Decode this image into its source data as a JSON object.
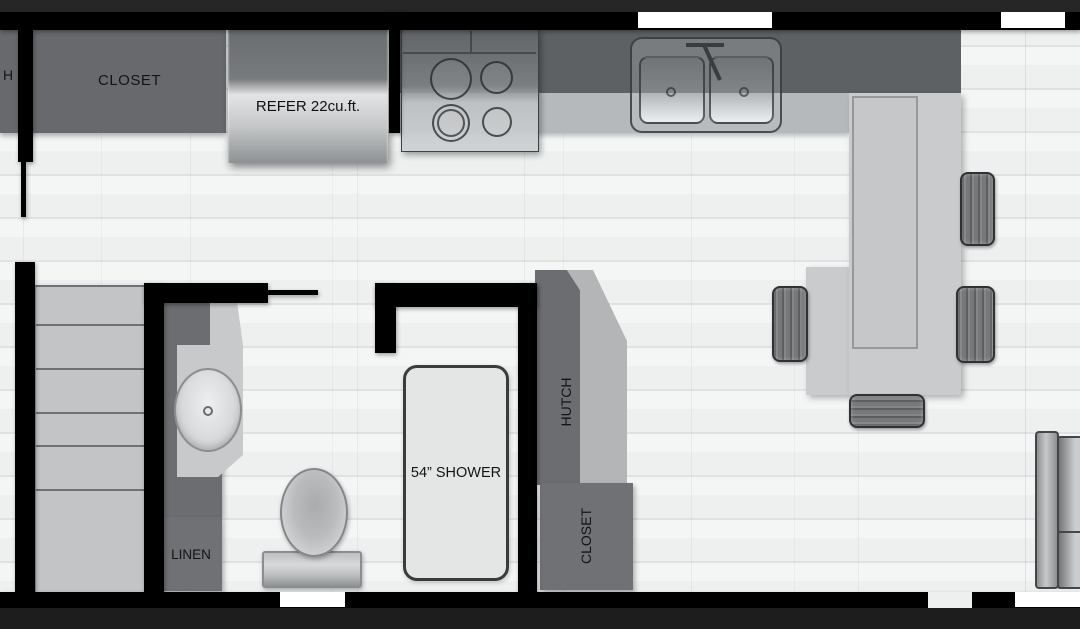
{
  "diagram_type": "rv-floor-plan",
  "labels": {
    "partial_left_room": "H",
    "closet_top": "CLOSET",
    "refrigerator": "REFER 22cu.ft.",
    "shower": "54” SHOWER",
    "hutch": "HUTCH",
    "closet_side": "CLOSET",
    "linen": "LINEN"
  },
  "colors": {
    "wall_black": "#000000",
    "outer_trim_top": "#262626",
    "outer_trim_bottom": "#1d1d1d",
    "floor_light": "#f0f1f1",
    "cabinet_dark_gray": "#67696c",
    "counter_backsplash": "#5e6164",
    "counter_front": "#b6b9bb",
    "island_gray": "#c9cbcd",
    "fixture_light_gray": "#e4e5e5",
    "window_white": "#ffffff"
  },
  "fixtures": {
    "kitchen": [
      "refrigerator",
      "cooktop-4-burner",
      "double-bowl-sink",
      "bar-island",
      "bar-stools-x4"
    ],
    "bathroom": [
      "vanity-oval-sink",
      "toilet",
      "shower-54in",
      "linen-cabinet"
    ],
    "living": [
      "sofa",
      "stairs",
      "hutch",
      "side-closet",
      "top-closet"
    ],
    "openings": [
      "window-top-center",
      "window-top-right",
      "window-bottom-left",
      "entry-opening-bottom",
      "window-bottom-right"
    ]
  }
}
